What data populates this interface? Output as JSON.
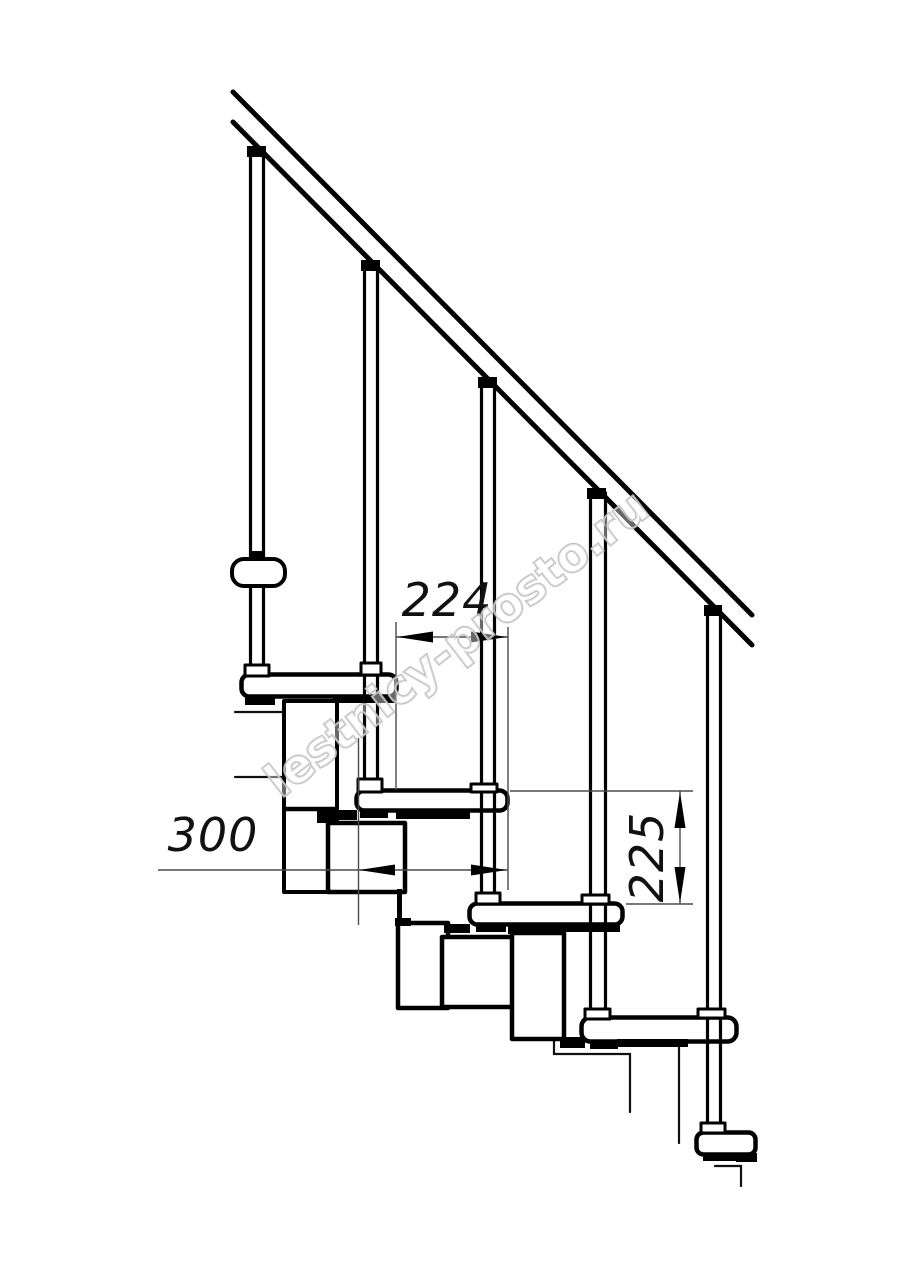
{
  "drawing": {
    "title": "Modular staircase side-view technical drawing",
    "dimensions": {
      "step_run": "224",
      "tread_depth": "300",
      "riser_height": "225"
    },
    "watermark": {
      "text": "lestnicy-prosto.ru"
    },
    "colors": {
      "line": "#000000",
      "dimension_line": "#4b4b4b",
      "dimension_text": "#111111",
      "watermark_stroke": "#bcbcbc",
      "background": "#ffffff"
    }
  }
}
